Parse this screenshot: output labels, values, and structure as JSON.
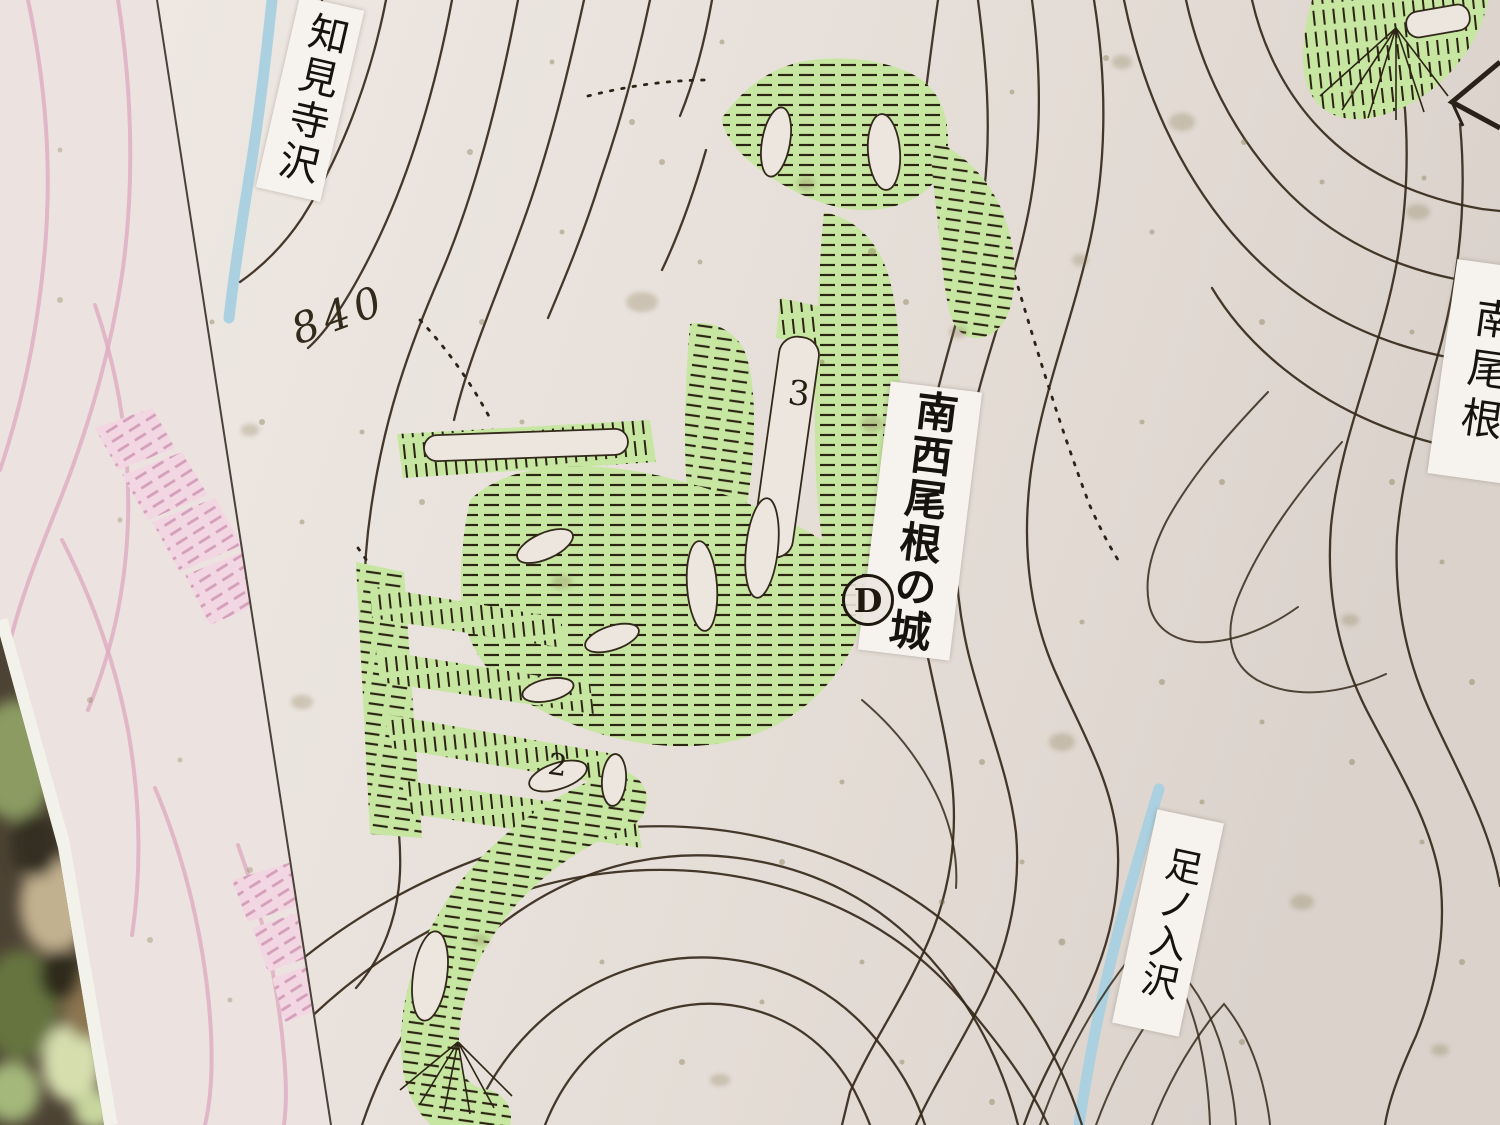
{
  "photo": {
    "description": "Photographed trailside sign: topographic map of a mountain castle site with green-shaded earthwork enclosures",
    "labels": {
      "stream_top_left": "知見寺沢",
      "castle_name": "南西尾根の城",
      "ridge_right": "南尾根",
      "stream_bottom_right": "足ノ入沢"
    },
    "markers": {
      "elevation": "840",
      "point": "D",
      "enclosure_3": "3",
      "enclosure_2": "2"
    },
    "colors": {
      "paper": "#e9e2dc",
      "castle_green": "#c6e6a1",
      "adjacent_map_pink": "#dfaec2",
      "stream_blue": "#a8d0e0",
      "contour_ink": "#36291b"
    }
  }
}
